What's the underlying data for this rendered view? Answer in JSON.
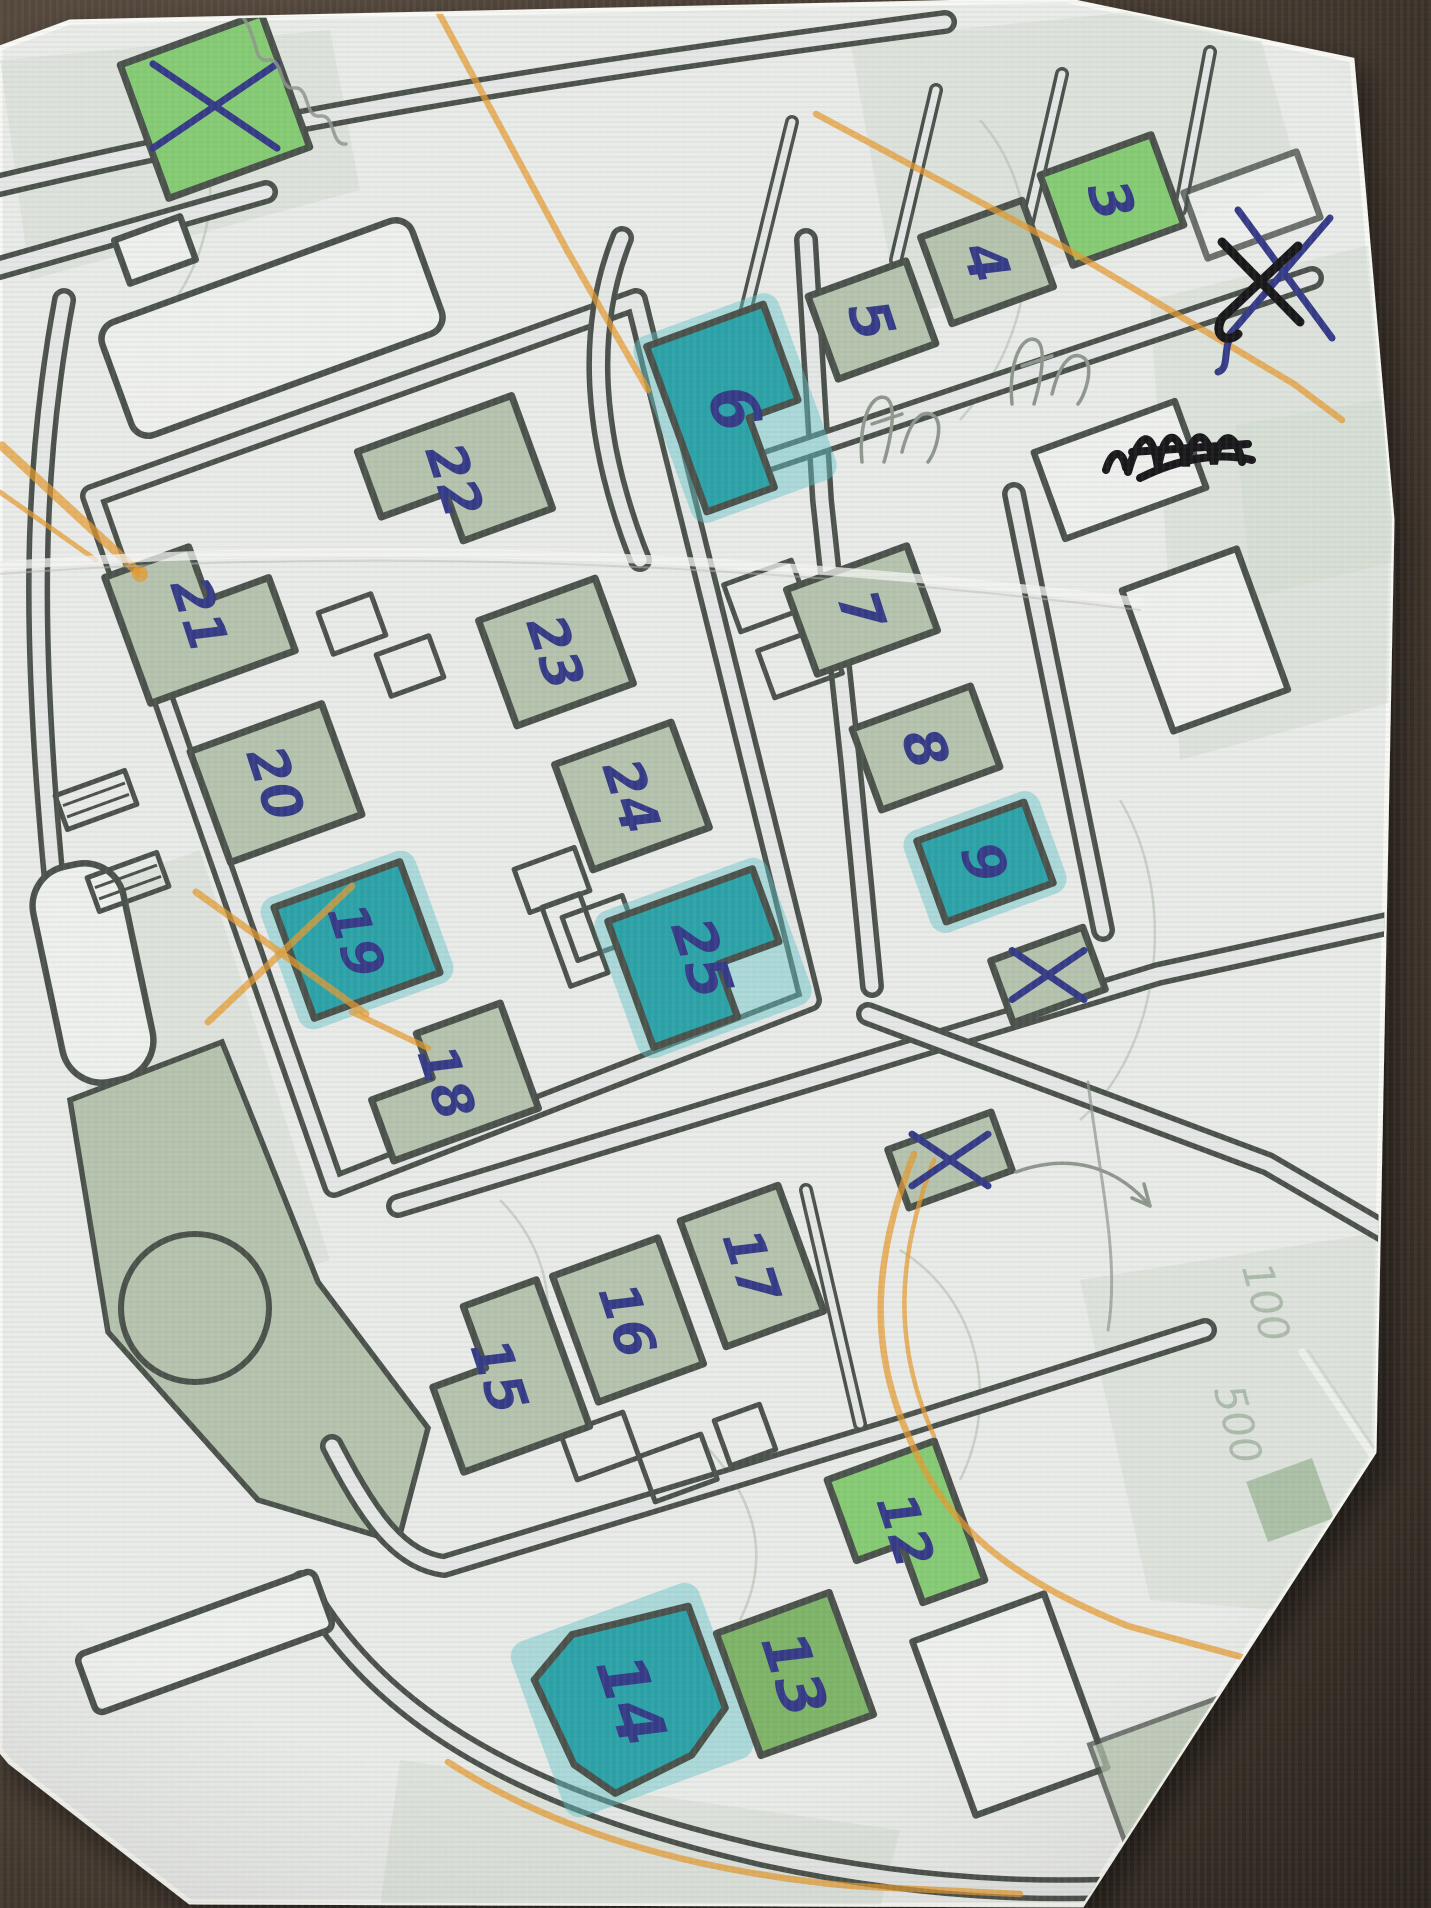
{
  "scene": {
    "kind": "photograph of a printed street map on a dark table",
    "colors": {
      "table_dark": "#2b241e",
      "table_light": "#5a4c40",
      "paper": "#e9ebe9",
      "mapwhite": "#eef0ee",
      "roadfill": "#e4e7e5",
      "ink": "#4a504a",
      "sage": "#b5c3ae",
      "green": "#85cb74",
      "mgreen": "#7eb468",
      "teal": "#2ba2a8",
      "tealglow": "#5fc3c8",
      "pen": "#343a86",
      "orange": "#e59a2f",
      "pencil": "#8e978d",
      "washgreen": "#cdd8ca"
    }
  },
  "buildings": [
    {
      "name": "building-x-topleft",
      "label": "",
      "cx": 215,
      "cy": 106,
      "w": 150,
      "h": 142,
      "rot": -20,
      "fill": "green",
      "shape": "rect",
      "xmark": 62
    },
    {
      "name": "building-3",
      "label": "3",
      "cx": 1112,
      "cy": 200,
      "w": 118,
      "h": 96,
      "rot": -20,
      "fill": "green",
      "shape": "rect",
      "fs": 56
    },
    {
      "name": "building-4",
      "label": "4",
      "cx": 987,
      "cy": 262,
      "w": 108,
      "h": 92,
      "rot": -20,
      "fill": "sage",
      "shape": "rect",
      "fs": 56
    },
    {
      "name": "building-5",
      "label": "5",
      "cx": 872,
      "cy": 320,
      "w": 104,
      "h": 88,
      "rot": -20,
      "fill": "sage",
      "shape": "rect",
      "fs": 56
    },
    {
      "name": "building-6",
      "label": "6",
      "cx": 735,
      "cy": 408,
      "w": 124,
      "h": 176,
      "rot": -20,
      "fill": "teal",
      "shape": "L-br",
      "fs": 64
    },
    {
      "name": "building-7",
      "label": "7",
      "cx": 862,
      "cy": 610,
      "w": 128,
      "h": 90,
      "rot": -20,
      "fill": "sage",
      "shape": "rect",
      "fs": 56
    },
    {
      "name": "building-8",
      "label": "8",
      "cx": 926,
      "cy": 748,
      "w": 126,
      "h": 86,
      "rot": -20,
      "fill": "sage",
      "shape": "rect",
      "fs": 56
    },
    {
      "name": "building-9",
      "label": "9",
      "cx": 985,
      "cy": 862,
      "w": 114,
      "h": 86,
      "rot": -20,
      "fill": "teal",
      "shape": "rect",
      "fs": 56
    },
    {
      "name": "building-x-mid",
      "label": "",
      "cx": 1048,
      "cy": 975,
      "w": 98,
      "h": 66,
      "rot": -20,
      "fill": "sage",
      "shape": "rect",
      "xmark": 36
    },
    {
      "name": "building-x-low",
      "label": "",
      "cx": 950,
      "cy": 1160,
      "w": 110,
      "h": 62,
      "rot": -20,
      "fill": "sage",
      "shape": "rect",
      "xmark": 38
    },
    {
      "name": "building-21",
      "label": "21",
      "cx": 200,
      "cy": 614,
      "w": 154,
      "h": 134,
      "rot": -20,
      "fill": "sage",
      "shape": "L-tr",
      "fs": 54
    },
    {
      "name": "building-22",
      "label": "22",
      "cx": 455,
      "cy": 480,
      "w": 164,
      "h": 120,
      "rot": -20,
      "fill": "sage",
      "shape": "L-bl",
      "fs": 54
    },
    {
      "name": "building-23",
      "label": "23",
      "cx": 556,
      "cy": 652,
      "w": 124,
      "h": 112,
      "rot": -20,
      "fill": "sage",
      "shape": "rect",
      "fs": 54
    },
    {
      "name": "building-24",
      "label": "24",
      "cx": 632,
      "cy": 796,
      "w": 124,
      "h": 112,
      "rot": -20,
      "fill": "sage",
      "shape": "rect",
      "fs": 54
    },
    {
      "name": "building-25",
      "label": "25",
      "cx": 703,
      "cy": 958,
      "w": 154,
      "h": 134,
      "rot": -20,
      "fill": "teal",
      "shape": "L-br",
      "fs": 58
    },
    {
      "name": "building-20",
      "label": "20",
      "cx": 276,
      "cy": 783,
      "w": 140,
      "h": 118,
      "rot": -20,
      "fill": "sage",
      "shape": "rect",
      "fs": 54
    },
    {
      "name": "building-19",
      "label": "19",
      "cx": 357,
      "cy": 940,
      "w": 134,
      "h": 118,
      "rot": -20,
      "fill": "teal",
      "shape": "rect",
      "fs": 54
    },
    {
      "name": "building-18",
      "label": "18",
      "cx": 447,
      "cy": 1082,
      "w": 154,
      "h": 112,
      "rot": -20,
      "fill": "sage",
      "shape": "L-tl",
      "fs": 54
    },
    {
      "name": "building-15",
      "label": "15",
      "cx": 500,
      "cy": 1376,
      "w": 134,
      "h": 156,
      "rot": -20,
      "fill": "sage",
      "shape": "L-tl",
      "fs": 54
    },
    {
      "name": "building-16",
      "label": "16",
      "cx": 628,
      "cy": 1320,
      "w": 112,
      "h": 134,
      "rot": -20,
      "fill": "sage",
      "shape": "rect",
      "fs": 54
    },
    {
      "name": "building-17",
      "label": "17",
      "cx": 752,
      "cy": 1266,
      "w": 104,
      "h": 134,
      "rot": -20,
      "fill": "sage",
      "shape": "rect",
      "fs": 54
    },
    {
      "name": "building-14",
      "label": "14",
      "cx": 632,
      "cy": 1700,
      "w": 170,
      "h": 164,
      "rot": -20,
      "fill": "teal",
      "shape": "pent",
      "fs": 66
    },
    {
      "name": "building-13",
      "label": "13",
      "cx": 795,
      "cy": 1674,
      "w": 120,
      "h": 130,
      "rot": -20,
      "fill": "mgreen",
      "shape": "rect",
      "fs": 62
    },
    {
      "name": "building-12",
      "label": "12",
      "cx": 906,
      "cy": 1530,
      "w": 114,
      "h": 148,
      "rot": -20,
      "fill": "green",
      "shape": "L-bl",
      "fs": 54
    }
  ],
  "label_rotation_deg": 72,
  "pen_x_scribble": {
    "note": "large blue X with black X crossed over it, top right margin",
    "cx": 1280,
    "cy": 272
  },
  "pencil_labels": [
    {
      "text": "100",
      "x": 1252,
      "y": 1306,
      "rot": 75
    },
    {
      "text": "500",
      "x": 1224,
      "y": 1428,
      "rot": 75
    }
  ]
}
